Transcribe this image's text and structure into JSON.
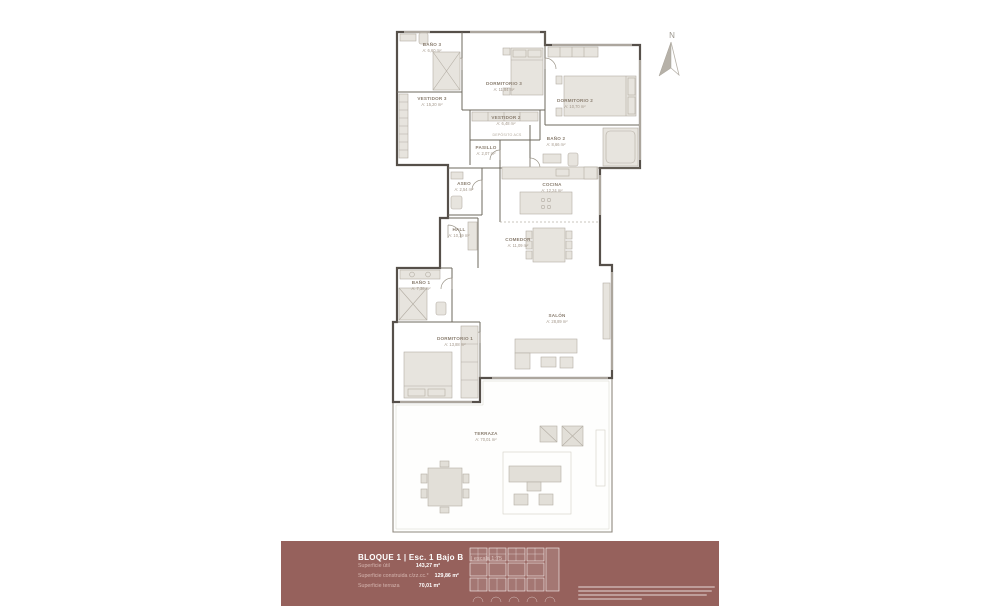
{
  "plan": {
    "north_label": "N",
    "rooms": [
      {
        "name": "BAÑO 3",
        "area": "A: 6,60 m²"
      },
      {
        "name": "DORMITORIO 3",
        "area": "A: 11,84 m²"
      },
      {
        "name": "VESTIDOR 3",
        "area": "A: 15,20 m²"
      },
      {
        "name": "DORMITORIO 2",
        "area": "A: 10,70 m²"
      },
      {
        "name": "VESTIDOR 2",
        "area": "A: 6,48 m²"
      },
      {
        "name": "DEPÓSITO ACS",
        "area": ""
      },
      {
        "name": "PASILLO",
        "area": "A: 2,07 m²"
      },
      {
        "name": "BAÑO 2",
        "area": "A: 8,66 m²"
      },
      {
        "name": "ASEO",
        "area": "A: 2,54 m²"
      },
      {
        "name": "COCINA",
        "area": "A: 12,24 m²"
      },
      {
        "name": "HALL",
        "area": "A: 10,19 m²"
      },
      {
        "name": "COMEDOR",
        "area": "A: 11,09 m²"
      },
      {
        "name": "BAÑO 1",
        "area": "A: 7,38 m²"
      },
      {
        "name": "DORMITORIO 1",
        "area": "A: 13,88 m²"
      },
      {
        "name": "SALÓN",
        "area": "A: 28,89 m²"
      },
      {
        "name": "TERRAZA",
        "area": "A: 70,01 m²"
      }
    ]
  },
  "banner": {
    "title": "BLOQUE 1 | Esc. 1 Bajo B",
    "scale_note": "| escala 1:75",
    "metrics": [
      {
        "label": "Superficie útil",
        "value": "143,27 m²"
      },
      {
        "label": "Superficie construida c/zz.cc.*",
        "value": "129,86 m²"
      },
      {
        "label": "Superficie terraza",
        "value": "70,01 m²"
      }
    ]
  },
  "colors": {
    "banner_bg": "#96615c",
    "wall": "#56504a",
    "label": "#8a7e70",
    "furniture_fill": "#e7e4de"
  }
}
